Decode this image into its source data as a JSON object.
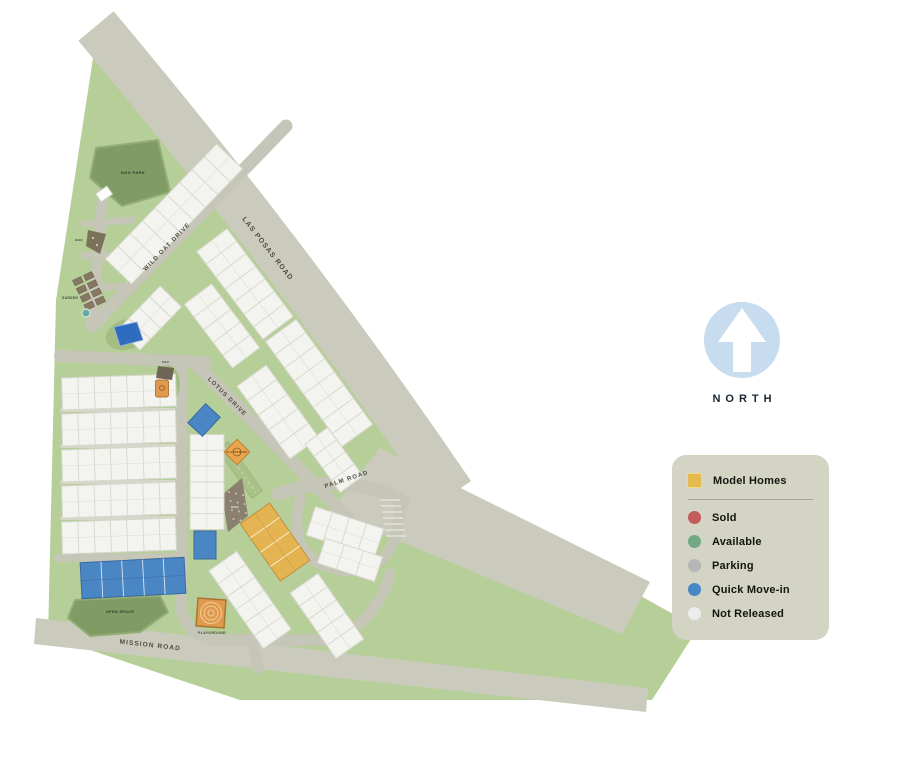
{
  "page": {
    "background": "#ffffff"
  },
  "north": {
    "label": "NORTH",
    "circle_color": "#c7dcee",
    "arrow_color": "#ffffff",
    "text_color": "#1b2630"
  },
  "legend": {
    "background": "#d3d4c3",
    "divider_color": "#a6a798",
    "items": [
      {
        "label": "Model Homes",
        "swatch": "square",
        "color": "#e5bb50",
        "border": "#f2d78c"
      },
      {
        "label": "Sold",
        "swatch": "circle",
        "color": "#c25b5b"
      },
      {
        "label": "Available",
        "swatch": "circle",
        "color": "#72a984"
      },
      {
        "label": "Parking",
        "swatch": "circle",
        "color": "#b5b6b7"
      },
      {
        "label": "Quick Move-in",
        "swatch": "circle",
        "color": "#4887c6"
      },
      {
        "label": "Not Released",
        "swatch": "circle",
        "color": "#ececec"
      }
    ]
  },
  "map": {
    "colors": {
      "site_green": "#b6ce98",
      "road": "#cbcbbd",
      "road_inner": "#c6c6b8",
      "park_green": "#7e9c64",
      "amenity_green": "#a3bd82",
      "building_not_released": "#f3f3ef",
      "building_stroke": "#d7d7cc",
      "building_model": "#e4b452",
      "building_model_stroke": "#c3923b",
      "building_quick_move_in": "#4b86c4",
      "building_quick_move_in_stroke": "#39699f",
      "orange": "#e09a4f",
      "brown": "#73694f",
      "pool_blue": "#2f6cc0",
      "label": "#4c4c41",
      "area_label": "#3e4636"
    },
    "road_labels": [
      {
        "text": "LAS POSAS ROAD",
        "x": 266,
        "y": 250,
        "rot": 52,
        "size": 7
      },
      {
        "text": "WILD OAT DRIVE",
        "x": 168,
        "y": 248,
        "rot": -46,
        "size": 6
      },
      {
        "text": "LOTUS DRIVE",
        "x": 226,
        "y": 398,
        "rot": 45,
        "size": 6
      },
      {
        "text": "PALM ROAD",
        "x": 347,
        "y": 481,
        "rot": -18,
        "size": 6
      },
      {
        "text": "MISSION ROAD",
        "x": 150,
        "y": 647,
        "rot": 6.5,
        "size": 6.5
      }
    ],
    "area_labels": [
      {
        "text": "DOG PARK",
        "x": 133,
        "y": 174,
        "size": 4,
        "color": "#2f3a26"
      },
      {
        "text": "BBQ",
        "x": 79,
        "y": 241,
        "size": 3,
        "color": "#3e4636"
      },
      {
        "text": "GARDEN",
        "x": 70,
        "y": 299,
        "size": 3.2,
        "color": "#3e4636"
      },
      {
        "text": "REC",
        "x": 166,
        "y": 363,
        "size": 3,
        "color": "#3e4636"
      },
      {
        "text": "PLAYGROUND",
        "x": 237,
        "y": 453,
        "size": 2.4,
        "color": "#5c4418"
      },
      {
        "text": "BBQ",
        "x": 235,
        "y": 508,
        "size": 3,
        "color": "#f1ead9"
      },
      {
        "text": "OPEN SPACE",
        "x": 120,
        "y": 613,
        "size": 3.8,
        "color": "#2f3a26"
      },
      {
        "text": "PLAYGROUND",
        "x": 212,
        "y": 634,
        "size": 3.4,
        "color": "#3e4636"
      }
    ],
    "buildings": [
      {
        "cx": 174,
        "cy": 214,
        "len": 160,
        "wid": 36,
        "rot": -46,
        "units": 9,
        "status": "not_released"
      },
      {
        "cx": 150,
        "cy": 318,
        "len": 60,
        "wid": 30,
        "rot": -46,
        "units": 4,
        "status": "not_released"
      },
      {
        "cx": 245,
        "cy": 284,
        "len": 110,
        "wid": 38,
        "rot": 53,
        "units": 7,
        "status": "not_released"
      },
      {
        "cx": 319,
        "cy": 383,
        "len": 130,
        "wid": 38,
        "rot": 54,
        "units": 8,
        "status": "not_released"
      },
      {
        "cx": 222,
        "cy": 326,
        "len": 80,
        "wid": 34,
        "rot": 53,
        "units": 5,
        "status": "not_released"
      },
      {
        "cx": 278,
        "cy": 412,
        "len": 90,
        "wid": 36,
        "rot": 54,
        "units": 5,
        "status": "not_released"
      },
      {
        "cx": 334,
        "cy": 460,
        "len": 60,
        "wid": 28,
        "rot": 54,
        "units": 4,
        "status": "not_released"
      },
      {
        "cx": 119,
        "cy": 392,
        "len": 114,
        "wid": 32,
        "rot": -2,
        "units": 7,
        "status": "not_released"
      },
      {
        "cx": 119,
        "cy": 428,
        "len": 114,
        "wid": 32,
        "rot": -2,
        "units": 7,
        "status": "not_released"
      },
      {
        "cx": 119,
        "cy": 464,
        "len": 114,
        "wid": 32,
        "rot": -2,
        "units": 7,
        "status": "not_released"
      },
      {
        "cx": 119,
        "cy": 500,
        "len": 114,
        "wid": 32,
        "rot": -2,
        "units": 7,
        "status": "not_released"
      },
      {
        "cx": 119,
        "cy": 536,
        "len": 114,
        "wid": 32,
        "rot": -2,
        "units": 7,
        "status": "not_released"
      },
      {
        "cx": 133,
        "cy": 578,
        "len": 104,
        "wid": 36,
        "rot": -3,
        "units": 5,
        "status": "quick_move_in"
      },
      {
        "cx": 207,
        "cy": 482,
        "len": 95,
        "wid": 34,
        "rot": 90,
        "units": 6,
        "status": "not_released"
      },
      {
        "cx": 204,
        "cy": 420,
        "len": 26,
        "wid": 20,
        "rot": -47,
        "units": 1,
        "status": "quick_move_in"
      },
      {
        "cx": 205,
        "cy": 545,
        "len": 28,
        "wid": 22,
        "rot": 90,
        "units": 1,
        "status": "quick_move_in"
      },
      {
        "cx": 275,
        "cy": 542,
        "len": 70,
        "wid": 36,
        "rot": 55,
        "units": 4,
        "status": "model"
      },
      {
        "cx": 250,
        "cy": 600,
        "len": 95,
        "wid": 34,
        "rot": 55,
        "units": 6,
        "status": "not_released"
      },
      {
        "cx": 327,
        "cy": 616,
        "len": 80,
        "wid": 34,
        "rot": 55,
        "units": 5,
        "status": "not_released"
      },
      {
        "cx": 345,
        "cy": 532,
        "len": 72,
        "wid": 30,
        "rot": 18,
        "units": 4,
        "status": "not_released"
      },
      {
        "cx": 350,
        "cy": 560,
        "len": 60,
        "wid": 26,
        "rot": 18,
        "units": 3,
        "status": "not_released"
      }
    ]
  }
}
